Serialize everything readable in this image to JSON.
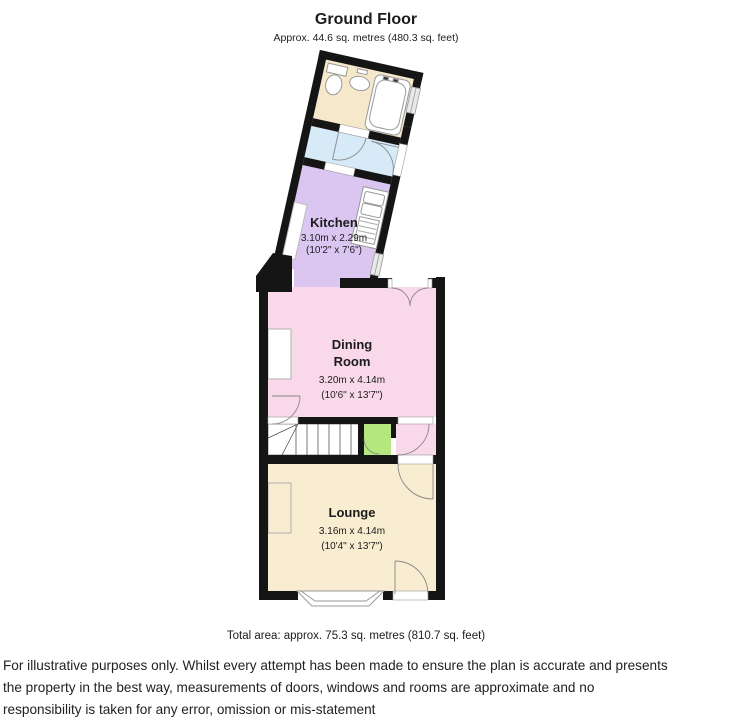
{
  "plan": {
    "title": "Ground Floor",
    "subtitle": "Approx. 44.6 sq. metres (480.3 sq. feet)",
    "total": "Total area: approx. 75.3 sq. metres (810.7 sq. feet)",
    "rooms": {
      "kitchen": {
        "name": "Kitchen",
        "metric": "3.10m x 2.29m",
        "imperial": "(10'2\" x 7'6\")"
      },
      "dining": {
        "name1": "Dining",
        "name2": "Room",
        "metric": "3.20m x 4.14m",
        "imperial": "(10'6\" x 13'7\")"
      },
      "lounge": {
        "name": "Lounge",
        "metric": "3.16m x 4.14m",
        "imperial": "(10'4\" x 13'7\")"
      }
    }
  },
  "disclaimer": {
    "line1": "For illustrative purposes only. Whilst every attempt has been made to ensure the plan is accurate and presents",
    "line2": "the property in the best way, measurements of doors, windows and rooms are approximate and no",
    "line3": "responsibility is taken for any error, omission or mis-statement"
  },
  "colors": {
    "wall": "#151515",
    "bathroom": "#f6e8cb",
    "landing": "#d6ebf7",
    "kitchen": "#dbc6f1",
    "dining": "#f9d8e9",
    "lounge": "#f8ecd1",
    "cupboard": "#b4e77e",
    "window": "#e9e9e9",
    "fixture": "#ffffff"
  }
}
